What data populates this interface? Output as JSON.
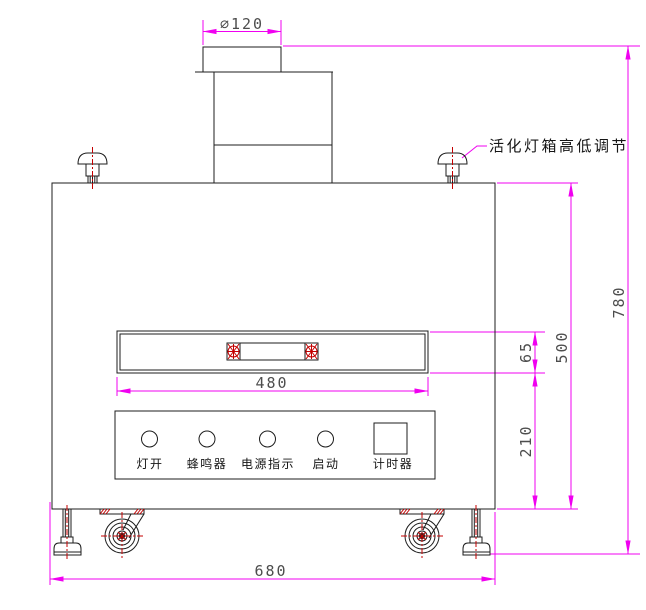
{
  "drawing": {
    "callout_label": "活化灯箱高低调节",
    "dimensions": {
      "duct_diameter": "∅120",
      "slot_width": "480",
      "slot_height": "65",
      "panel_zone_height": "210",
      "body_height": "500",
      "overall_height": "780",
      "overall_width": "680"
    },
    "panel": {
      "labels": [
        "灯开",
        "蜂鸣器",
        "电源指示",
        "启动",
        "计时器"
      ]
    },
    "colors": {
      "outline": "#1c1c1c",
      "dimension": "#f000f0",
      "centerline": "#c40000",
      "dim_text": "#4d4d4d"
    }
  }
}
